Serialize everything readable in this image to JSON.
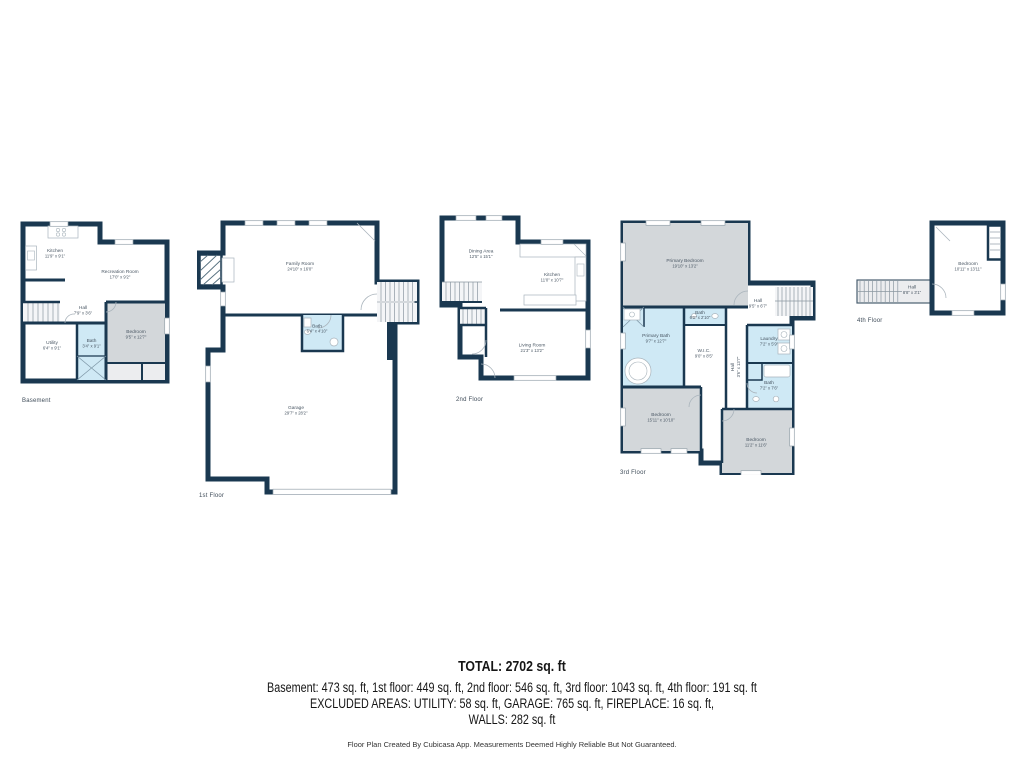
{
  "colors": {
    "wall": "#1a3850",
    "room": "#ecedef",
    "room_gray": "#d3d7da",
    "room_bath_blue": "#cfe9f5",
    "label_text": "#4a5764",
    "summary_text": "#161616"
  },
  "floors": [
    {
      "label": "Basement",
      "rooms": [
        {
          "name": "Kitchen",
          "dims": "11'9\" x 9'1\""
        },
        {
          "name": "Recreation Room",
          "dims": "17'0\" x 9'2\""
        },
        {
          "name": "Hall",
          "dims": "7'9\" x 3'6\""
        },
        {
          "name": "Utility",
          "dims": "6'4\" x 9'1\""
        },
        {
          "name": "Bath",
          "dims": "3'4\" x 9'1\""
        },
        {
          "name": "Bedroom",
          "dims": "9'5\" x 12'7\""
        }
      ]
    },
    {
      "label": "1st Floor",
      "rooms": [
        {
          "name": "Family Room",
          "dims": "24'10\" x 16'0\""
        },
        {
          "name": "Bath",
          "dims": "6'4\" x 4'10\""
        },
        {
          "name": "Garage",
          "dims": "29'7\" x 28'2\""
        }
      ]
    },
    {
      "label": "2nd Floor",
      "rooms": [
        {
          "name": "Dining Area",
          "dims": "12'5\" x 15'1\""
        },
        {
          "name": "Kitchen",
          "dims": "11'0\" x 10'7\""
        },
        {
          "name": "Living Room",
          "dims": "21'3\" x 13'2\""
        }
      ]
    },
    {
      "label": "3rd Floor",
      "rooms": [
        {
          "name": "Primary Bedroom",
          "dims": "19'10\" x 13'2\""
        },
        {
          "name": "Hall",
          "dims": "9'5\" x 6'7\""
        },
        {
          "name": "Bath",
          "dims": "6'0\" x 2'10\""
        },
        {
          "name": "Primary Bath",
          "dims": "9'7\" x 12'7\""
        },
        {
          "name": "W.I.C.",
          "dims": "9'0\" x 8'5\""
        },
        {
          "name": "Hall",
          "dims": "3'6\" x 13'7\""
        },
        {
          "name": "Laundry",
          "dims": "7'2\" x 5'9\""
        },
        {
          "name": "Bath",
          "dims": "7'2\" x 7'6\""
        },
        {
          "name": "Bedroom",
          "dims": "15'11\" x 10'10\""
        },
        {
          "name": "Bedroom",
          "dims": "11'2\" x 11'6\""
        }
      ]
    },
    {
      "label": "4th Floor",
      "rooms": [
        {
          "name": "Bedroom",
          "dims": "10'11\" x 13'11\""
        },
        {
          "name": "Hall",
          "dims": "8'8\" x 3'1\""
        }
      ]
    }
  ],
  "summary": {
    "total": "TOTAL: 2702 sq. ft",
    "floors_line": "Basement: 473 sq. ft, 1st floor: 449 sq. ft, 2nd floor: 546 sq. ft, 3rd floor: 1043 sq. ft, 4th floor: 191 sq. ft",
    "excluded_line": "EXCLUDED AREAS: UTILITY: 58 sq. ft, GARAGE: 765 sq. ft, FIREPLACE: 16 sq. ft,",
    "walls_line": "WALLS: 282 sq. ft",
    "disclaimer": "Floor Plan Created By Cubicasa App. Measurements Deemed Highly Reliable But Not Guaranteed."
  }
}
